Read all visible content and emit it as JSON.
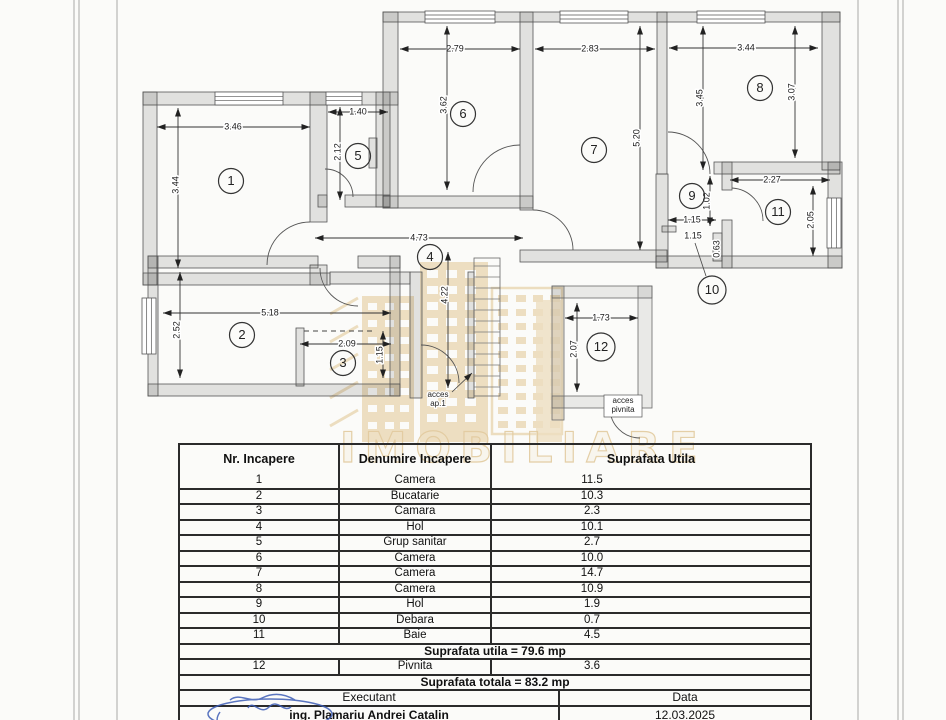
{
  "page": {
    "watermark_text": "IMOBILIARE"
  },
  "plan": {
    "rooms": [
      "1",
      "2",
      "3",
      "4",
      "5",
      "6",
      "7",
      "8",
      "9",
      "10",
      "11",
      "12"
    ],
    "dims": {
      "r1_w": "3.46",
      "r1_h": "3.44",
      "r5_w": "1.40",
      "r5_h": "2.12",
      "r6_w": "2.79",
      "r6_h": "3.62",
      "r7_w": "2.83",
      "r7_h": "5.20",
      "r8_w": "3.44",
      "r8_h_left": "3.45",
      "r8_h_right": "3.07",
      "r9_w": "1.15",
      "r9_h": "1.02",
      "r10_w": "1.15",
      "r10_h": "0.63",
      "r11_w": "2.27",
      "r11_h": "2.05",
      "r4_w": "4.73",
      "r4_h": "4.22",
      "r2_w": "5.18",
      "r2_h": "2.52",
      "r3_w": "2.09",
      "r3_h": "1.15",
      "r12_w": "1.73",
      "r12_h": "2.07"
    },
    "labels": {
      "acces_ap1_l1": "acces",
      "acces_ap1_l2": "ap.1",
      "acces_pivnita_l1": "acces",
      "acces_pivnita_l2": "pivnita"
    }
  },
  "table": {
    "headers": [
      "Nr. Incapere",
      "Denumire Incapere",
      "Suprafata Utila"
    ],
    "rows": [
      [
        "1",
        "Camera",
        "11.5"
      ],
      [
        "2",
        "Bucatarie",
        "10.3"
      ],
      [
        "3",
        "Camara",
        "2.3"
      ],
      [
        "4",
        "Hol",
        "10.1"
      ],
      [
        "5",
        "Grup sanitar",
        "2.7"
      ],
      [
        "6",
        "Camera",
        "10.0"
      ],
      [
        "7",
        "Camera",
        "14.7"
      ],
      [
        "8",
        "Camera",
        "10.9"
      ],
      [
        "9",
        "Hol",
        "1.9"
      ],
      [
        "10",
        "Debara",
        "0.7"
      ],
      [
        "11",
        "Baie",
        "4.5"
      ]
    ],
    "subtotal": "Suprafata utila = 79.6 mp",
    "row12": [
      "12",
      "Pivnita",
      "3.6"
    ],
    "total": "Suprafata totala = 83.2 mp",
    "footer_headers": [
      "Executant",
      "Data"
    ],
    "footer_values": [
      "ing. Plamariu Andrei Catalin",
      "12.03.2025"
    ]
  }
}
